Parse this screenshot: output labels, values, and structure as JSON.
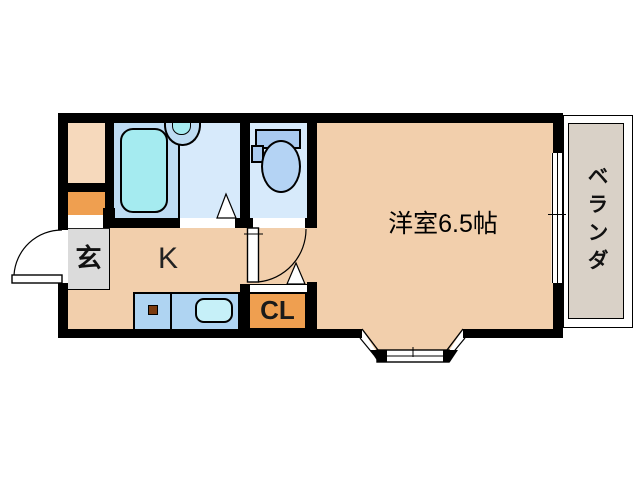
{
  "type": "floor-plan",
  "labels": {
    "entrance": "玄",
    "kitchen": "K",
    "closet": "CL",
    "main_room": "洋室6.5帖",
    "veranda": "ベランダ"
  },
  "colors": {
    "wall": "#000000",
    "floor-peach": "#F2CFAC",
    "storage-peach": "#F6D9BC",
    "accent-orange": "#EF9F50",
    "entrance-gray": "#DBDBDB",
    "veranda-gray": "#D9D1C7",
    "bathroom-blue": "#BEDCF3",
    "room-lightblue": "#D7EAFB",
    "tub-cyan": "#A5EBF0",
    "counter-blue": "#AFD4F2",
    "sink-cyan": "#C6F0F8",
    "toilet-tank-blue": "#A9CAF0",
    "toilet-bowl-blue": "#B4D3F4"
  },
  "fixtures": [
    "bathtub",
    "wash-basin",
    "toilet",
    "kitchen-counter",
    "kitchen-sink",
    "stove-point",
    "entrance-door",
    "toilet-door",
    "bay-window",
    "veranda-window",
    "washroom-door-mark",
    "closet-door-mark"
  ]
}
